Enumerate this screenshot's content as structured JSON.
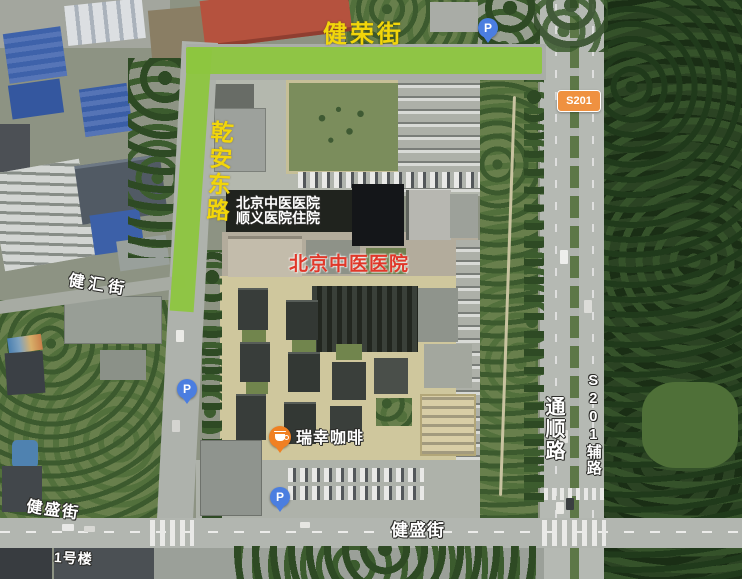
{
  "map": {
    "roads": {
      "jianrong_street": "健荣街",
      "qianan_east_road": "乾安东路",
      "jianhui_street": "健汇街",
      "jiansheng_street_west": "健盛街",
      "jiansheng_street_center": "健盛街",
      "tongshun_road": "通顺路",
      "s201_frontage_road": "S201辅路",
      "s201_shield": "S201"
    },
    "pois": {
      "hospital_inpatient": {
        "line1": "北京中医医院",
        "line2": "顺义医院住院"
      },
      "hospital_main": "北京中医医院",
      "luckin_coffee": "瑞幸咖啡",
      "building_no1": "1号楼"
    },
    "icons": {
      "parking": "P"
    },
    "colors": {
      "route_highlight": "#8dc63f",
      "road_label_yellow": "#f2d60a",
      "hospital_label_red": "#e0382a",
      "s201_shield_orange": "#ef9140",
      "parking_pin_blue": "#4b7ee0",
      "luckin_pin_orange": "#f08022"
    }
  }
}
